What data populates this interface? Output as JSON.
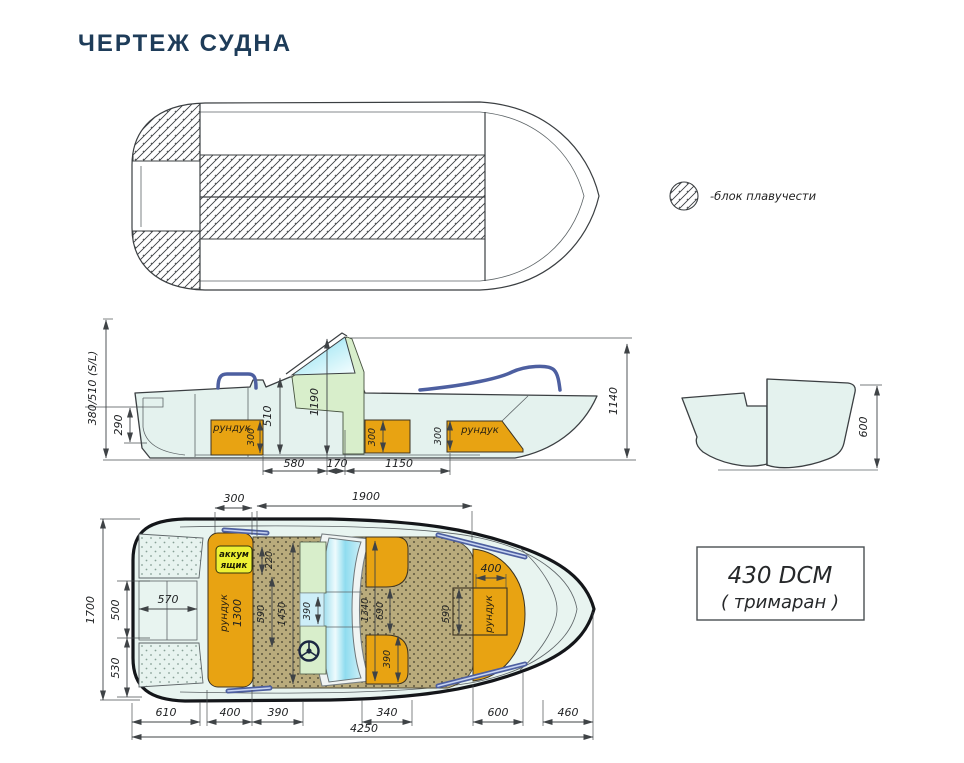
{
  "title": "ЧЕРТЕЖ СУДНА",
  "legend": {
    "label": "-блок плавучести"
  },
  "model_box": {
    "line1": "430 DCM",
    "line2": "( тримаран )"
  },
  "colors": {
    "title_text": "#1e3c59",
    "hull_fill": "#e4f2ee",
    "floor_tan": "#b9ab7c",
    "locker_orange": "#e8a312",
    "battery_yellow": "#eef033",
    "console_green": "#d8eecb",
    "windshield_cyan": "#7fd4ea",
    "rail_blue": "#4d5fa0",
    "drawing_line": "#3b3f42"
  },
  "side_view": {
    "dim_sl": "380/510 (S/L)",
    "dim_290": "290",
    "dim_510": "510",
    "dim_1190": "1190",
    "dim_1140": "1140",
    "dim_580": "580",
    "dim_170": "170",
    "dim_1150": "1150",
    "locker_aft_label": "рундук",
    "locker_aft_h": "300",
    "locker_mid_h": "300",
    "locker_fwd_h": "300",
    "locker_fwd_label": "рундук"
  },
  "section_view": {
    "dim_600": "600"
  },
  "plan_view": {
    "dim_300": "300",
    "dim_1900": "1900",
    "dim_1700": "1700",
    "dim_500": "500",
    "dim_530": "530",
    "dim_570": "570",
    "stern_locker_label": "рундук",
    "stern_locker_len": "1300",
    "battery_line1": "аккум",
    "battery_line2": "ящик",
    "dim_220": "220",
    "dim_590_floor": "590",
    "dim_1450": "1450",
    "dim_390_gap": "390",
    "dim_1340": "1340",
    "dim_690": "690",
    "dim_390_seat": "390",
    "bow_dim_400": "400",
    "bow_dim_590": "590",
    "bow_locker_label": "рундук",
    "dim_610": "610",
    "dim_400b": "400",
    "dim_390b": "390",
    "dim_340": "340",
    "dim_600b": "600",
    "dim_460": "460",
    "dim_4250": "4250"
  }
}
